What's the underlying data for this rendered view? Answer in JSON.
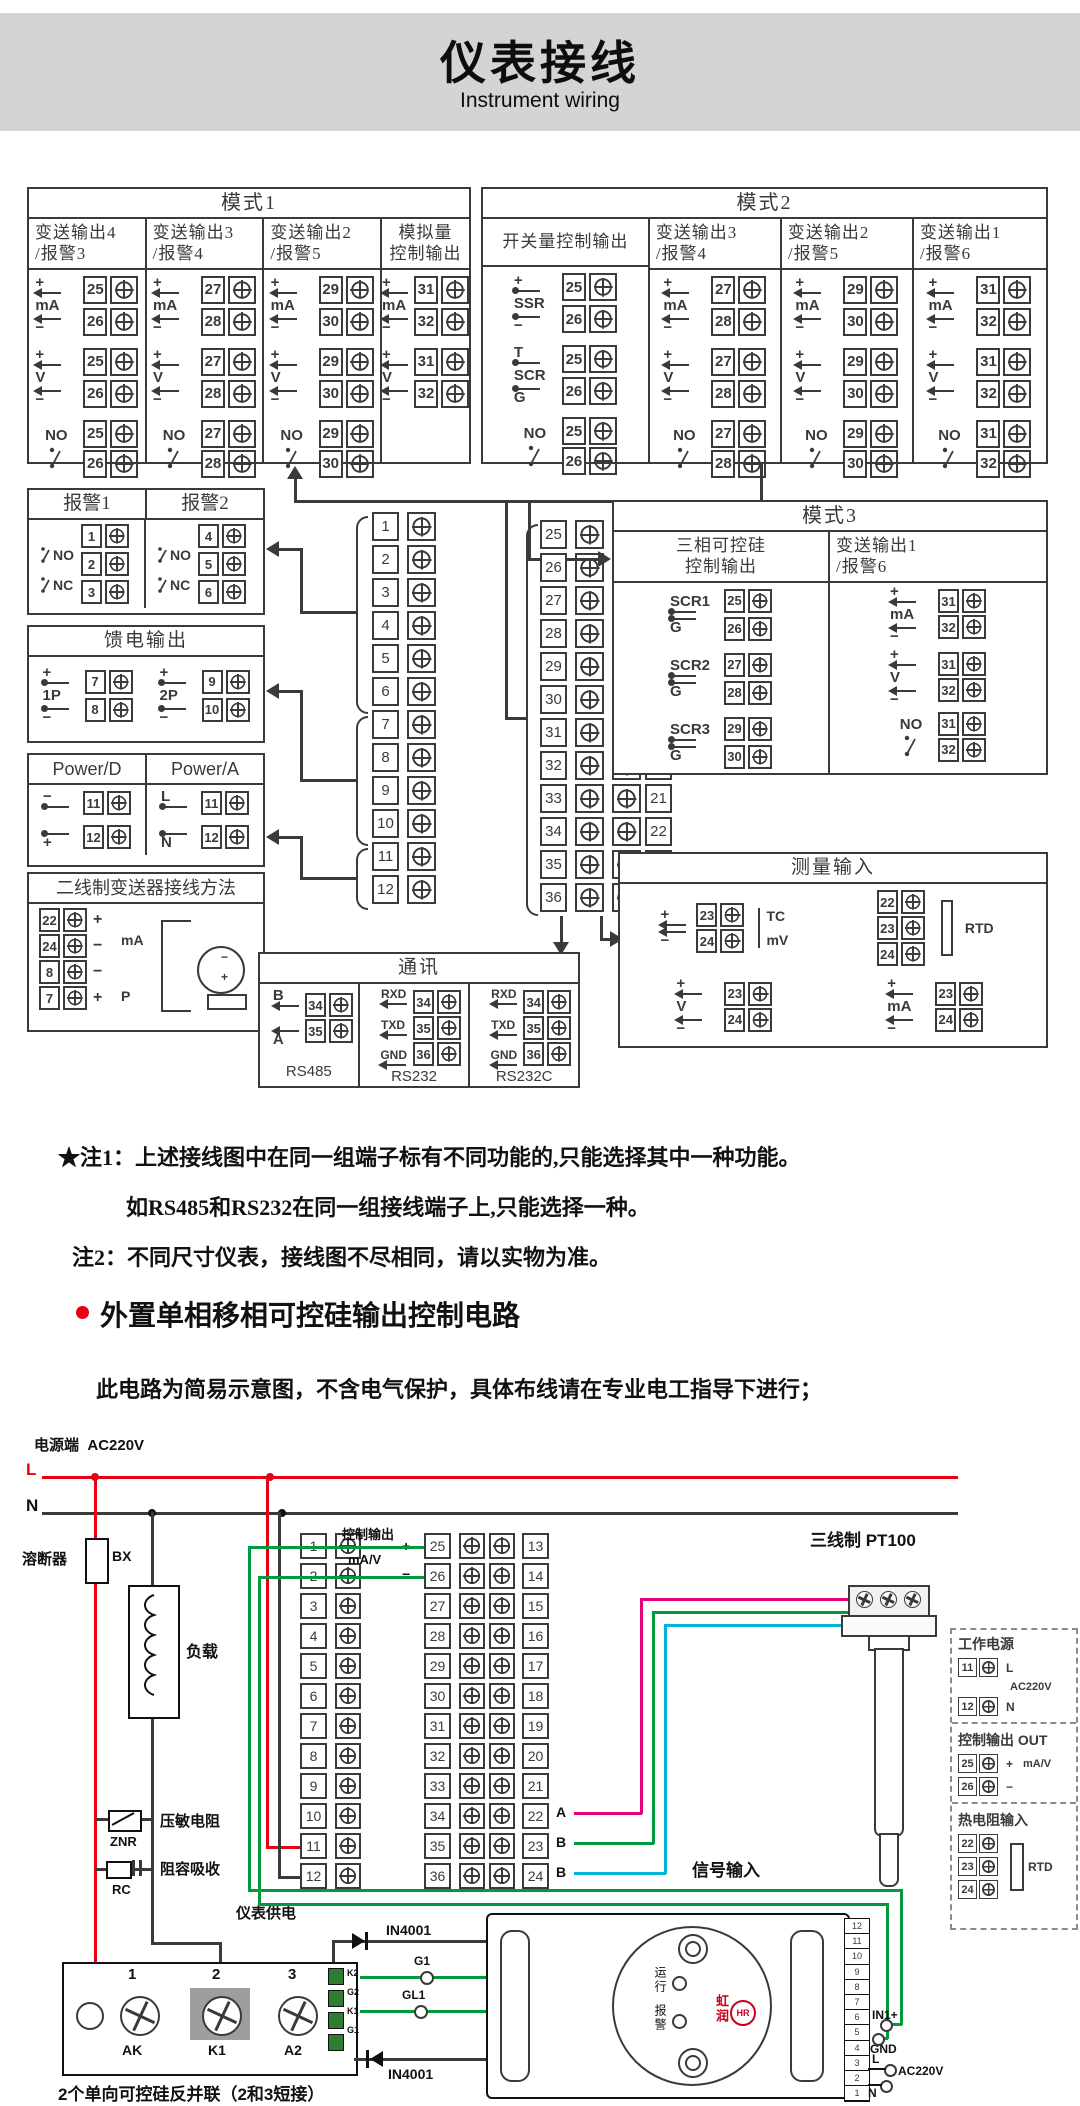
{
  "header": {
    "title": "仪表接线",
    "subtitle": "Instrument wiring"
  },
  "sym": {
    "plus": "+",
    "minus": "−",
    "ma": "mA",
    "v": "V",
    "no": "NO",
    "nc": "NC"
  },
  "mode1": {
    "title": "模式1",
    "cols": [
      {
        "h1": "变送输出4",
        "h2": "/报警3",
        "a": "25",
        "b": "26"
      },
      {
        "h1": "变送输出3",
        "h2": "/报警4",
        "a": "27",
        "b": "28"
      },
      {
        "h1": "变送输出2",
        "h2": "/报警5",
        "a": "29",
        "b": "30"
      }
    ],
    "col4": {
      "h1": "模拟量",
      "h2": "控制输出",
      "a": "31",
      "b": "32"
    }
  },
  "mode2": {
    "title": "模式2",
    "sw": {
      "h": "开关量控制输出",
      "ssr": "SSR",
      "scr": "SCR",
      "t": "T",
      "g": "G",
      "a": "25",
      "b": "26"
    },
    "cols": [
      {
        "h1": "变送输出3",
        "h2": "/报警4",
        "a": "27",
        "b": "28"
      },
      {
        "h1": "变送输出2",
        "h2": "/报警5",
        "a": "29",
        "b": "30"
      },
      {
        "h1": "变送输出1",
        "h2": "/报警6",
        "a": "31",
        "b": "32"
      }
    ]
  },
  "alarm": {
    "h1": "报警1",
    "h2": "报警2",
    "t1": [
      "1",
      "2",
      "3"
    ],
    "t2": [
      "4",
      "5",
      "6"
    ]
  },
  "feed": {
    "title": "馈电输出",
    "g1": "1P",
    "g1a": "7",
    "g1b": "8",
    "g2": "2P",
    "g2a": "9",
    "g2b": "10"
  },
  "power": {
    "h1": "Power/D",
    "h2": "Power/A",
    "da": "11",
    "db": "12",
    "aa": "11",
    "ab": "12",
    "l": "L",
    "n": "N"
  },
  "twowire": {
    "title": "二线制变送器接线方法",
    "t1": "22",
    "t2": "24",
    "t3": "8",
    "t4": "7",
    "ma": "mA",
    "p": "P"
  },
  "strip": {
    "left": [
      "1",
      "2",
      "3",
      "4",
      "5",
      "6",
      "7",
      "8",
      "9",
      "10",
      "11",
      "12"
    ],
    "mid": [
      "25",
      "26",
      "27",
      "28",
      "29",
      "30",
      "31",
      "32",
      "33",
      "34",
      "35",
      "36"
    ],
    "right": [
      "13",
      "14",
      "15",
      "16",
      "17",
      "18",
      "19",
      "20",
      "21",
      "22",
      "23",
      "24"
    ]
  },
  "mode3": {
    "title": "模式3",
    "c1h1": "三相可控硅",
    "c1h2": "控制输出",
    "g": "G",
    "rows": [
      [
        "SCR1",
        "25",
        "26"
      ],
      [
        "SCR2",
        "27",
        "28"
      ],
      [
        "SCR3",
        "29",
        "30"
      ]
    ],
    "c2h1": "变送输出1",
    "c2h2": "/报警6",
    "a": "31",
    "b": "32"
  },
  "comm": {
    "title": "通讯",
    "rs485": {
      "r1l": "B",
      "r1t": "34",
      "r2l": "A",
      "r2t": "35",
      "name": "RS485"
    },
    "rs232": {
      "r1l": "RXD",
      "r1t": "34",
      "r2l": "TXD",
      "r2t": "35",
      "r3l": "GND",
      "r3t": "36",
      "name": "RS232"
    },
    "rs232c": {
      "r1l": "RXD",
      "r1t": "34",
      "r2l": "TXD",
      "r2t": "35",
      "r3l": "GND",
      "r3t": "36",
      "name": "RS232C"
    }
  },
  "measure": {
    "title": "测量输入",
    "tc": "TC",
    "mv": "mV",
    "r1a": "23",
    "r1b": "24",
    "rtd": {
      "t": [
        "22",
        "23",
        "24"
      ],
      "name": "RTD"
    },
    "v": {
      "a": "23",
      "b": "24"
    },
    "ma": {
      "a": "23",
      "b": "24"
    }
  },
  "notes": {
    "n1": "★注1：上述接线图中在同一组端子标有不同功能的,只能选择其中一种功能。",
    "n1b": "如RS485和RS232在同一组接线端子上,只能选择一种。",
    "n2": "注2：不同尺寸仪表，接线图不尽相同，请以实物为准。"
  },
  "sec2": {
    "title": "外置单相移相可控硅输出控制电路",
    "warn": "此电路为简易示意图，不含电气保护，具体布线请在专业电工指导下进行；",
    "src": "电源端",
    "ac": "AC220V",
    "l": "L",
    "n": "N",
    "fuse": "溶断器",
    "bx": "BX",
    "load": "负载",
    "znr_l": "压敏电阻",
    "znr": "ZNR",
    "rc_l": "阻容吸收",
    "rc": "RC",
    "supply": "仪表供电",
    "ctrl": "控制输出",
    "mav": "mA/V",
    "plus": "+",
    "minus": "−",
    "pt": "三线制 PT100",
    "sig": "信号输入",
    "abb": [
      "A",
      "B",
      "B"
    ],
    "d1": "IN4001",
    "d2": "IN4001",
    "scr_note": "2个单向可控硅反并联（2和3短接）",
    "scr_nums": [
      "1",
      "2",
      "3"
    ],
    "scr_labs": [
      "AK",
      "K1",
      "A2"
    ],
    "gate": [
      "K2",
      "G2",
      "K1",
      "G1"
    ],
    "g1": "G1",
    "gl1": "GL1"
  },
  "board": {
    "run": "运行",
    "alarm": "报警",
    "brand": "虹润",
    "mark": "HR",
    "terms": [
      "12",
      "11",
      "10",
      "9",
      "8",
      "7",
      "6",
      "5",
      "4",
      "3",
      "2",
      "1"
    ],
    "in1": "IN1+",
    "gnd": "GND",
    "l": "L",
    "n": "N",
    "ac": "AC220V"
  },
  "panel": {
    "p1": {
      "t": "工作电源",
      "a": "11",
      "b": "12",
      "l": "L",
      "n": "N",
      "ac": "AC220V"
    },
    "p2": {
      "t": "控制输出 OUT",
      "a": "25",
      "b": "26",
      "plus": "+",
      "minus": "−",
      "sig": "mA/V"
    },
    "p3": {
      "t": "热电阻输入",
      "name": "RTD"
    }
  }
}
